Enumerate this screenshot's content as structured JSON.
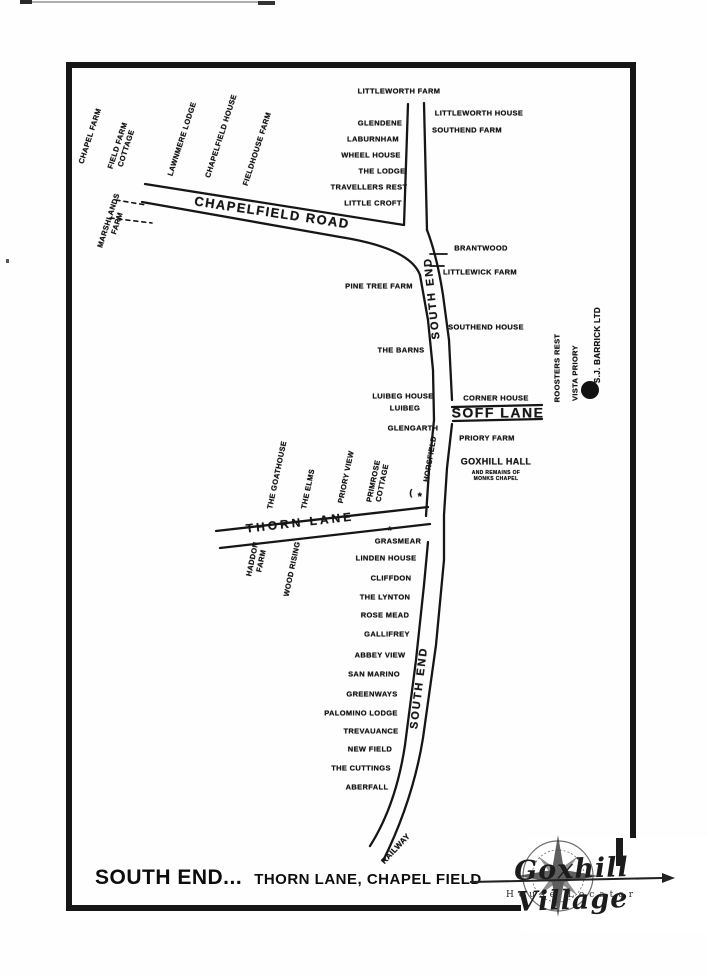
{
  "title": {
    "main": "SOUTH END...",
    "sub": "THORN LANE, CHAPEL FIELD"
  },
  "logo": {
    "name": "Goxhill Village",
    "subtitle": "House Locator"
  },
  "map_labels": [
    {
      "id": "littleworth-farm",
      "text": "LITTLEWORTH FARM",
      "x": 399,
      "y": 91
    },
    {
      "id": "littleworth-house",
      "text": "LITTLEWORTH HOUSE",
      "x": 479,
      "y": 113
    },
    {
      "id": "southend-farm",
      "text": "SOUTHEND FARM",
      "x": 467,
      "y": 130
    },
    {
      "id": "glendene",
      "text": "GLENDENE",
      "x": 380,
      "y": 123
    },
    {
      "id": "laburnham",
      "text": "LABURNHAM",
      "x": 373,
      "y": 139
    },
    {
      "id": "wheel-house",
      "text": "WHEEL HOUSE",
      "x": 371,
      "y": 155
    },
    {
      "id": "the-lodge",
      "text": "THE LODGE",
      "x": 382,
      "y": 171
    },
    {
      "id": "travellers-rest",
      "text": "TRAVELLERS REST",
      "x": 369,
      "y": 187
    },
    {
      "id": "little-croft",
      "text": "LITTLE CROFT",
      "x": 373,
      "y": 203
    },
    {
      "id": "chapel-farm",
      "text": "CHAPEL FARM",
      "x": 90,
      "y": 136,
      "rot": -72
    },
    {
      "id": "field-farm-cottage",
      "text": "FIELD FARM\nCOTTAGE",
      "x": 122,
      "y": 147,
      "rot": -72
    },
    {
      "id": "lawnmere-lodge",
      "text": "LAWNMERE LODGE",
      "x": 182,
      "y": 139,
      "rot": -72
    },
    {
      "id": "chapelfield-house",
      "text": "CHAPELFIELD HOUSE",
      "x": 221,
      "y": 136,
      "rot": -72
    },
    {
      "id": "fieldhouse-farm",
      "text": "FIELDHOUSE FARM",
      "x": 257,
      "y": 149,
      "rot": -72
    },
    {
      "id": "marshlands-farm",
      "text": "MARSHLANDS\nFARM",
      "x": 113,
      "y": 222,
      "rot": -72
    },
    {
      "id": "chapelfield-road",
      "text": "CHAPELFIELD ROAD",
      "x": 272,
      "y": 213,
      "rot": 8.5,
      "fs": 13,
      "ls": 1.5
    },
    {
      "id": "brantwood",
      "text": "BRANTWOOD",
      "x": 481,
      "y": 248
    },
    {
      "id": "littlewick-farm",
      "text": "LITTLEWICK FARM",
      "x": 480,
      "y": 272
    },
    {
      "id": "pine-tree-farm",
      "text": "PINE TREE FARM",
      "x": 379,
      "y": 286
    },
    {
      "id": "south-end-upper",
      "text": "SOUTH END",
      "x": 433,
      "y": 298,
      "rot": -96,
      "fs": 11,
      "ls": 2
    },
    {
      "id": "southend-house",
      "text": "SOUTHEND HOUSE",
      "x": 486,
      "y": 327
    },
    {
      "id": "the-barns",
      "text": "THE BARNS",
      "x": 401,
      "y": 350
    },
    {
      "id": "roosters-rest",
      "text": "ROOSTERS REST",
      "x": 557,
      "y": 368,
      "rot": -90
    },
    {
      "id": "vista-priory",
      "text": "VISTA PRIORY",
      "x": 575,
      "y": 373,
      "rot": -90
    },
    {
      "id": "sj-barrick-ltd",
      "text": "S.J. BARRICK LTD",
      "x": 598,
      "y": 345,
      "rot": -90,
      "fs": 8
    },
    {
      "id": "luibeg-house",
      "text": "LUIBEG HOUSE",
      "x": 403,
      "y": 396
    },
    {
      "id": "luibeg",
      "text": "LUIBEG",
      "x": 405,
      "y": 408
    },
    {
      "id": "corner-house",
      "text": "CORNER HOUSE",
      "x": 496,
      "y": 398
    },
    {
      "id": "soff-lane",
      "text": "SOFF LANE",
      "x": 498,
      "y": 413,
      "fs": 14,
      "ls": 1.5
    },
    {
      "id": "glengarth",
      "text": "GLENGARTH",
      "x": 413,
      "y": 428
    },
    {
      "id": "priory-farm",
      "text": "PRIORY FARM",
      "x": 487,
      "y": 438
    },
    {
      "id": "goxhill-hall",
      "text": "GOXHILL HALL",
      "x": 496,
      "y": 462,
      "fs": 9
    },
    {
      "id": "goxhill-hall-note",
      "text": "AND REMAINS OF\nMONKS CHAPEL",
      "x": 496,
      "y": 476,
      "fs": 5
    },
    {
      "id": "horsfield",
      "text": "HORSFIELD",
      "x": 430,
      "y": 459,
      "rot": -80
    },
    {
      "id": "horsfield-paren",
      "text": "(",
      "x": 411,
      "y": 493,
      "fs": 9
    },
    {
      "id": "horsfield-star",
      "text": "*",
      "x": 420,
      "y": 498,
      "fs": 11
    },
    {
      "id": "the-goathouse",
      "text": "THE GOATHOUSE",
      "x": 277,
      "y": 475,
      "rot": -78
    },
    {
      "id": "the-elms",
      "text": "THE ELMS",
      "x": 308,
      "y": 489,
      "rot": -78
    },
    {
      "id": "priory-view",
      "text": "PRIORY VIEW",
      "x": 346,
      "y": 477,
      "rot": -78
    },
    {
      "id": "primrose-cottage",
      "text": "PRIMROSE\nCOTTAGE",
      "x": 378,
      "y": 482,
      "rot": -78
    },
    {
      "id": "thorn-lane",
      "text": "THORN LANE",
      "x": 300,
      "y": 523,
      "rot": -6.5,
      "fs": 12,
      "ls": 3
    },
    {
      "id": "haddon-farm",
      "text": "HADDON\nFARM",
      "x": 257,
      "y": 560,
      "rot": -78
    },
    {
      "id": "wood-rising",
      "text": "WOOD RISING",
      "x": 292,
      "y": 569,
      "rot": -78
    },
    {
      "id": "grasmear-star",
      "text": "*",
      "x": 390,
      "y": 532,
      "fs": 11
    },
    {
      "id": "grasmear",
      "text": "GRASMEAR",
      "x": 398,
      "y": 541
    },
    {
      "id": "linden-house",
      "text": "LINDEN HOUSE",
      "x": 386,
      "y": 558
    },
    {
      "id": "cliffdon",
      "text": "CLIFFDON",
      "x": 391,
      "y": 578
    },
    {
      "id": "the-lynton",
      "text": "THE LYNTON",
      "x": 385,
      "y": 597
    },
    {
      "id": "rose-mead",
      "text": "ROSE MEAD",
      "x": 385,
      "y": 615
    },
    {
      "id": "gallifrey",
      "text": "GALLIFREY",
      "x": 387,
      "y": 634
    },
    {
      "id": "abbey-view",
      "text": "ABBEY VIEW",
      "x": 380,
      "y": 655
    },
    {
      "id": "san-marino",
      "text": "SAN MARINO",
      "x": 374,
      "y": 674
    },
    {
      "id": "greenways",
      "text": "GREENWAYS",
      "x": 372,
      "y": 694
    },
    {
      "id": "palomino-lodge",
      "text": "PALOMINO LODGE",
      "x": 361,
      "y": 713
    },
    {
      "id": "trevauance",
      "text": "TREVAUANCE",
      "x": 371,
      "y": 731
    },
    {
      "id": "new-field",
      "text": "NEW FIELD",
      "x": 370,
      "y": 749
    },
    {
      "id": "the-cuttings",
      "text": "THE CUTTINGS",
      "x": 361,
      "y": 768
    },
    {
      "id": "aberfall",
      "text": "ABERFALL",
      "x": 367,
      "y": 787
    },
    {
      "id": "south-end-lower",
      "text": "SOUTH END",
      "x": 420,
      "y": 688,
      "rot": -83,
      "fs": 11,
      "ls": 2
    },
    {
      "id": "railway",
      "text": "RAILWAY",
      "x": 396,
      "y": 849,
      "rot": -47,
      "fs": 8
    }
  ],
  "markers": [
    {
      "id": "sj-barrick-dot",
      "x": 590,
      "y": 390,
      "r": 9
    }
  ],
  "colors": {
    "ink": "#161616",
    "paper": "#fefefe"
  }
}
